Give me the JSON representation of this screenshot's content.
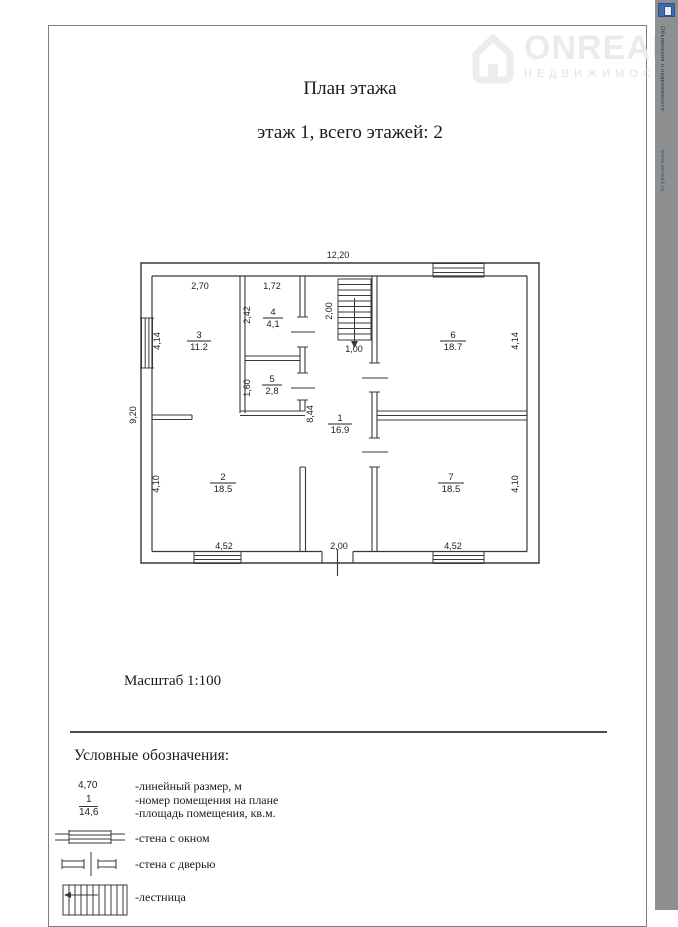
{
  "header": {
    "title": "План этажа",
    "subtitle": "этаж 1, всего этажей: 2",
    "scale": "Масштаб 1:100"
  },
  "watermark": {
    "brand": "ONREALT",
    "tagline": "НЕДВИЖИМОСТЬ"
  },
  "sidebar": {
    "vertical_text_top": "Объявления о недвижимости",
    "vertical_text_url": "www.onrealt.ru"
  },
  "plan": {
    "overall_width": "12,20",
    "overall_height": "9,20",
    "rooms": {
      "r1": {
        "num": "1",
        "area": "16.9"
      },
      "r2": {
        "num": "2",
        "area": "18.5"
      },
      "r3": {
        "num": "3",
        "area": "11.2"
      },
      "r4": {
        "num": "4",
        "area": "4,1"
      },
      "r5": {
        "num": "5",
        "area": "2,8"
      },
      "r6": {
        "num": "6",
        "area": "18.7"
      },
      "r7": {
        "num": "7",
        "area": "18.5"
      }
    },
    "dims": {
      "d270": "2,70",
      "d172": "1,72",
      "d242": "2,42",
      "d160": "1,60",
      "d414_left": "4,14",
      "d414_right": "4,14",
      "d200_stairs": "2,00",
      "d100": "1,00",
      "d844": "8,44",
      "d410_left": "4,10",
      "d410_right": "4,10",
      "d452_left": "4,52",
      "d452_right": "4,52",
      "d200_door": "2,00"
    }
  },
  "legend": {
    "title": "Условные обозначения:",
    "dim_sample": "4,70",
    "dim_label": "-линейный размер, м",
    "frac_num": "1",
    "frac_den": "14,6",
    "frac_label1": "-номер помещения на плане",
    "frac_label2": "-площадь помещения, кв.м.",
    "window_label": "-стена с окном",
    "door_label": "-стена с дверью",
    "stairs_label": "-лестница"
  }
}
